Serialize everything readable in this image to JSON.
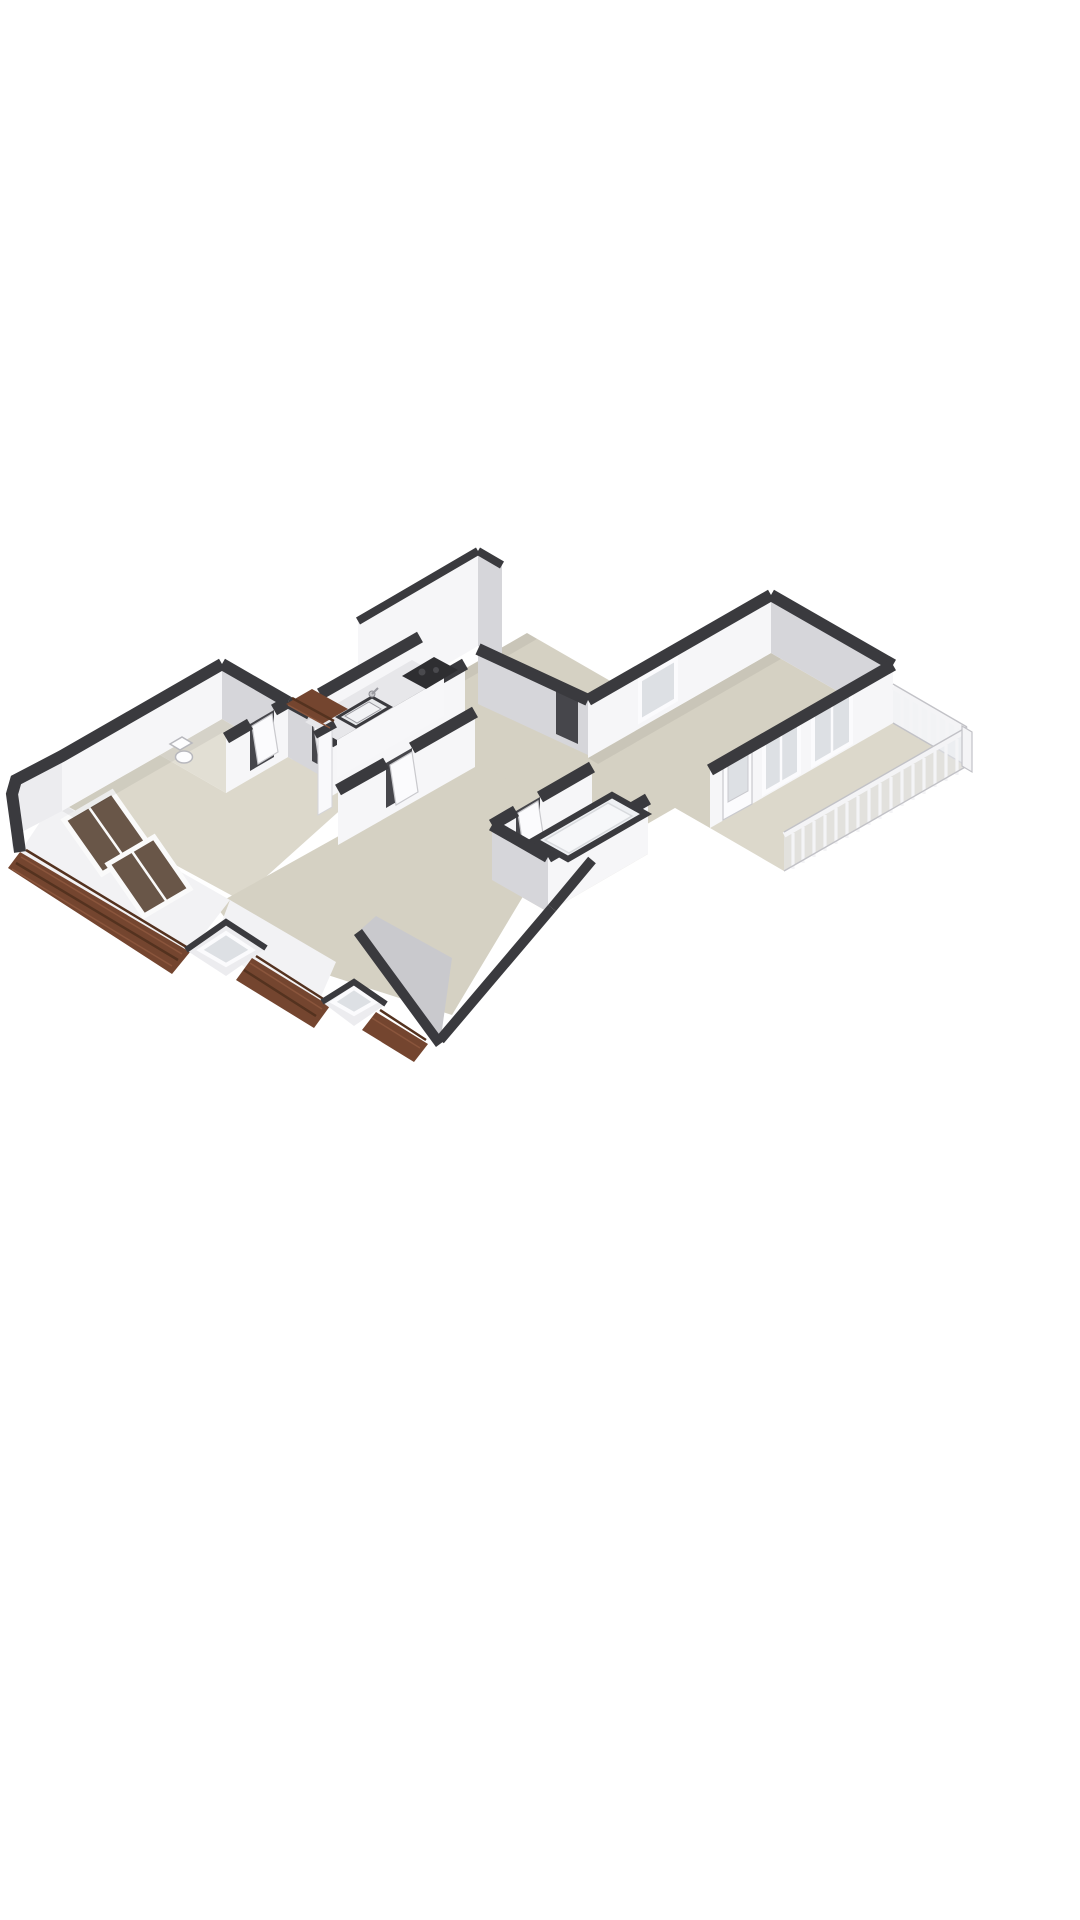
{
  "meta": {
    "kind": "3d-floorplan-render",
    "projection": "isometric-birdseye",
    "storey": "attic-floor-apartment",
    "visible_text": ""
  },
  "colors": {
    "page-bg": "#ffffff",
    "wall-top": "#3a3a3e",
    "wall-face-light": "#f6f6f8",
    "wall-face-dim": "#ececef",
    "wall-face-shade": "#d6d6da",
    "wall-face-dark": "#c9c9cd",
    "floor-main": "#d5d1c3",
    "floor-light": "#dcd8cb",
    "floor-pale": "#e2dfd4",
    "roof-tile": "#74452f",
    "roof-tile-line": "#54321f",
    "roof-tile-light": "#8a553c",
    "skylight-glass": "#695648",
    "window-glass": "#dde0e4",
    "rail-white": "#f4f4f6",
    "rail-edge": "#c2c2c7",
    "cooktop": "#2e2e31",
    "fixture-stroke": "#b8b8bd",
    "counter-top": "#e7e7ea",
    "opening-inner": "#eef0f3",
    "gap-dark": "#46464b"
  },
  "scene": {
    "rooms": [
      {
        "name": "entrance-hall"
      },
      {
        "name": "toilet-room"
      },
      {
        "name": "kitchen"
      },
      {
        "name": "hallway"
      },
      {
        "name": "living-room"
      },
      {
        "name": "bedroom-lower"
      },
      {
        "name": "storage-room"
      },
      {
        "name": "bedroom-right"
      },
      {
        "name": "balcony"
      }
    ],
    "features": {
      "roof-skylights": 2,
      "dormer-windows": 2,
      "tiled-roof-sections": 3,
      "wall-windows": 3,
      "balcony-door": 1,
      "interior-doors": 4,
      "balcony-railing-sides": 2,
      "kitchen-sink": 1,
      "kitchen-cooktop": 1,
      "toilet-fixture": 1,
      "floor-opening": 1,
      "tall-stair-volume": 1
    }
  }
}
